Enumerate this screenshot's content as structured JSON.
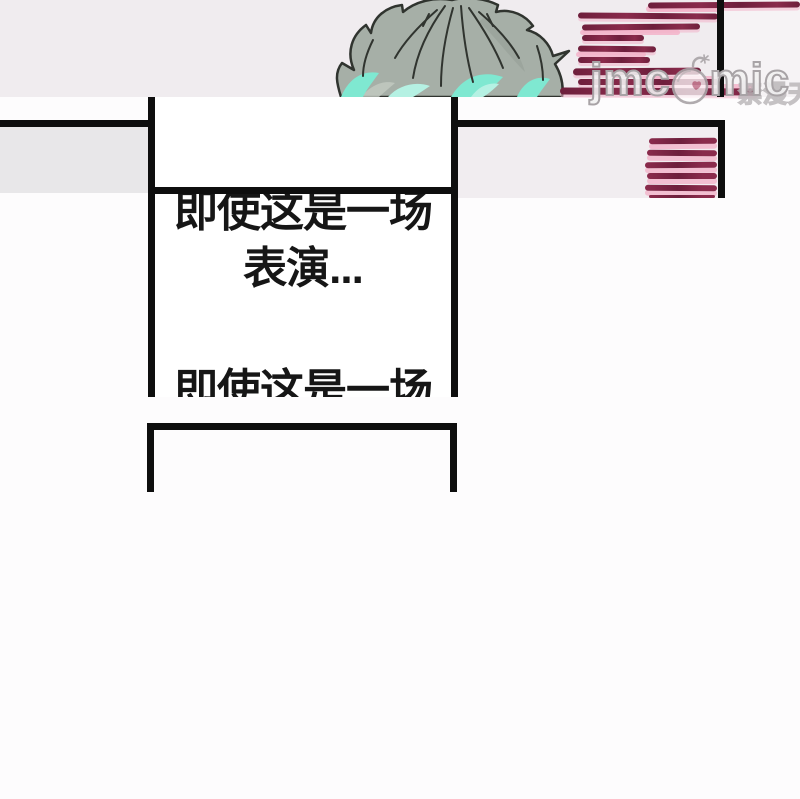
{
  "watermark": {
    "text_left": "jmc",
    "text_right": "mic",
    "cjk_text": "禁漫天堂",
    "icon": "bomb-mascot-icon"
  },
  "speech": {
    "block1_line1": "即使这是一场",
    "block1_line2": "表演...",
    "block2_line1": "即使这是一场"
  },
  "colors": {
    "top_bg": "#f0ecef",
    "top_bg_right": "#f6f3f5",
    "left_fill": "#e8e7e9",
    "right_fill": "#f1edf0",
    "ink": "#0e0e0e",
    "text": "#161616",
    "maroon": "#8a2b4c",
    "maroon_dark": "#6e1f3c",
    "pink": "#f3b3c9",
    "hair_base": "#a6afa7",
    "hair_shade": "#949d95",
    "hair_light": "#c3cbc2",
    "teal": "#7fe8d1",
    "teal_light": "#b5f1e3",
    "outline": "#30342f",
    "wm_stroke": "#a8a3a6",
    "heart": "#b45a74"
  }
}
